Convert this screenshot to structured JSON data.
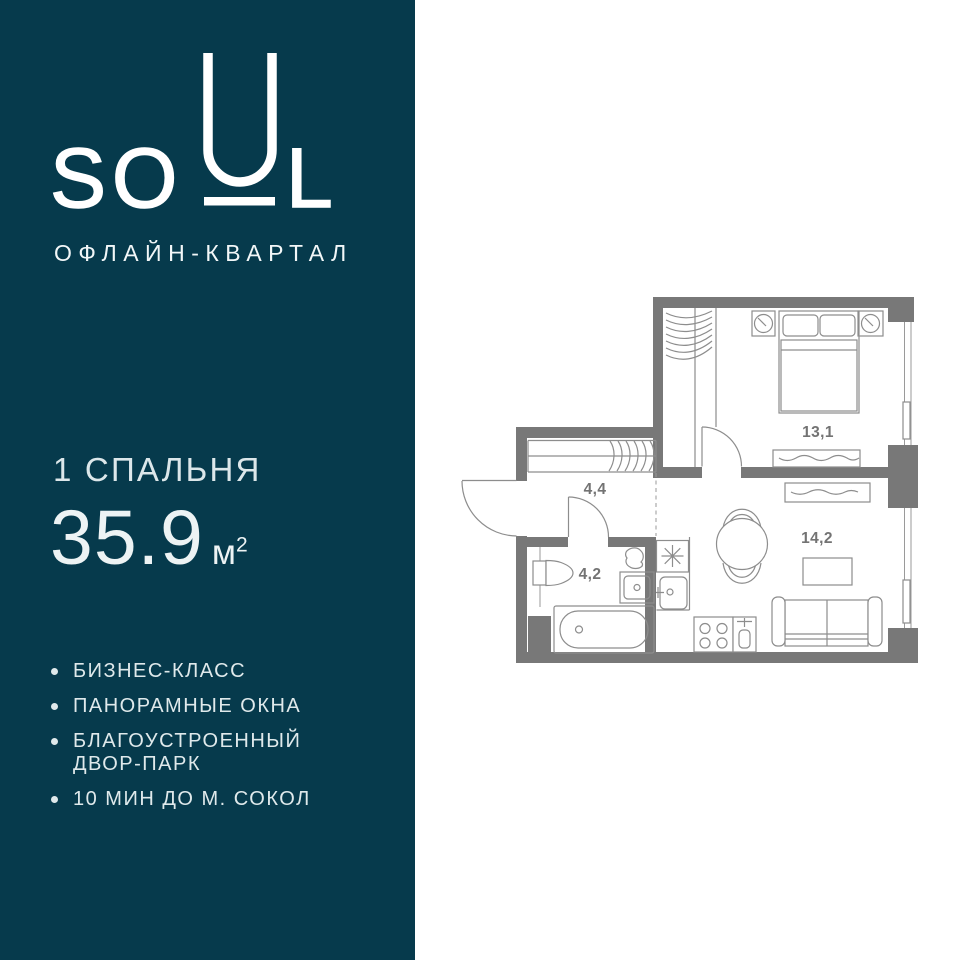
{
  "brand": {
    "logo_so": "SO",
    "logo_l": "L",
    "subtitle": "ОФЛАЙН-КВАРТАЛ"
  },
  "listing": {
    "bedrooms": "1 СПАЛЬНЯ",
    "area_value": "35.9",
    "area_unit": "м",
    "area_exponent": "2"
  },
  "features": [
    {
      "label": "БИЗНЕС-КЛАСС"
    },
    {
      "label": "ПАНОРАМНЫЕ ОКНА"
    },
    {
      "label": "БЛАГОУСТРОЕННЫЙ ДВОР-ПАРК"
    },
    {
      "label": "10 МИН ДО М. СОКОЛ"
    }
  ],
  "floor_plan": {
    "rooms": [
      {
        "id": "bedroom",
        "area_label": "13,1"
      },
      {
        "id": "hallway",
        "area_label": "4,4"
      },
      {
        "id": "bathroom",
        "area_label": "4,2"
      },
      {
        "id": "living_kitchen",
        "area_label": "14,2"
      }
    ]
  },
  "colors": {
    "panel_background": "#063a4c",
    "panel_text": "#e3edef",
    "wall_gray": "#787878",
    "furniture_gray": "#8d8d8d",
    "room_label_gray": "#737373"
  }
}
